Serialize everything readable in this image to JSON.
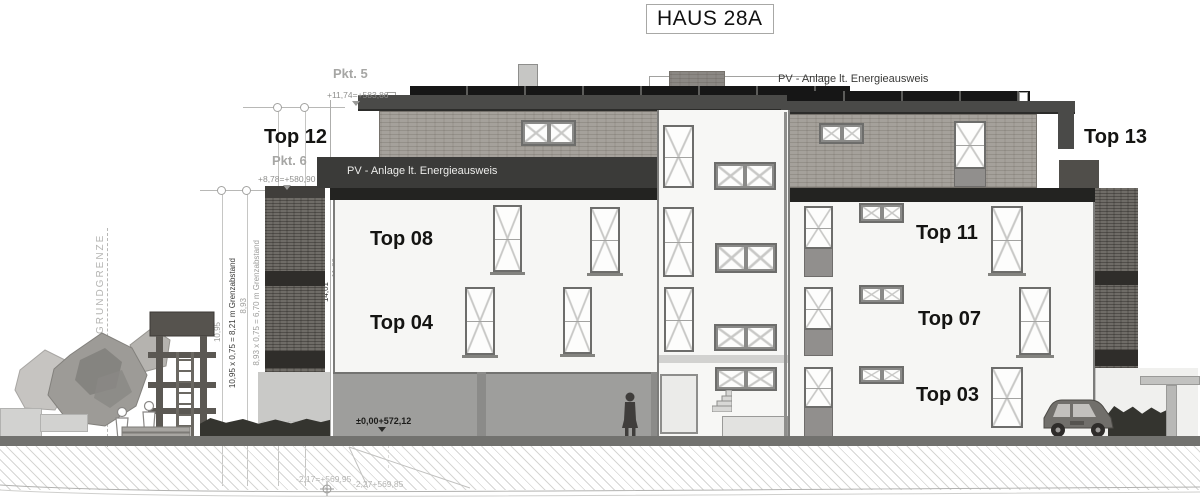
{
  "title": "HAUS 28A",
  "apartment_labels": {
    "top12": "Top 12",
    "top13": "Top 13",
    "top08": "Top 08",
    "top04": "Top 04",
    "top11": "Top 11",
    "top07": "Top 07",
    "top03": "Top 03"
  },
  "point_labels": {
    "pkt5": "Pkt. 5",
    "pkt6": "Pkt. 6"
  },
  "pv_labels": {
    "band": "PV - Anlage lt. Energieausweis",
    "roof": "PV - Anlage lt. Energieausweis"
  },
  "site_labels": {
    "grundgrenze": "GRUNDGRENZE"
  },
  "levels": {
    "roof_top": "+11,74=+583,86",
    "attic_top": "+8,78=+580,90",
    "ground_floor": "±0,00+572,12",
    "entrance": "-0,15=+571,97",
    "excavation_1": "-2,17=+569,95",
    "excavation_2": "-2,27+569,85"
  },
  "dimensions": {
    "height_left": "10,95",
    "setback_left": "10,95 x 0,75 = 8,21 m Grenzabstand",
    "height_right": "8,93",
    "setback_right": "8,93 x 0,75 = 6,70 m Grenzabstand",
    "total_height": "14,01",
    "upper_height": "11,89"
  },
  "colors": {
    "facade": "#f6f6f4",
    "garage": "#9e9e9c",
    "roof_slab": "#4a4a48",
    "pv_panel": "#161616",
    "pv_band": "#3b3b39",
    "cladding": "#a5a19b",
    "background_building": "#6f6c67",
    "ground": "#72726f"
  }
}
